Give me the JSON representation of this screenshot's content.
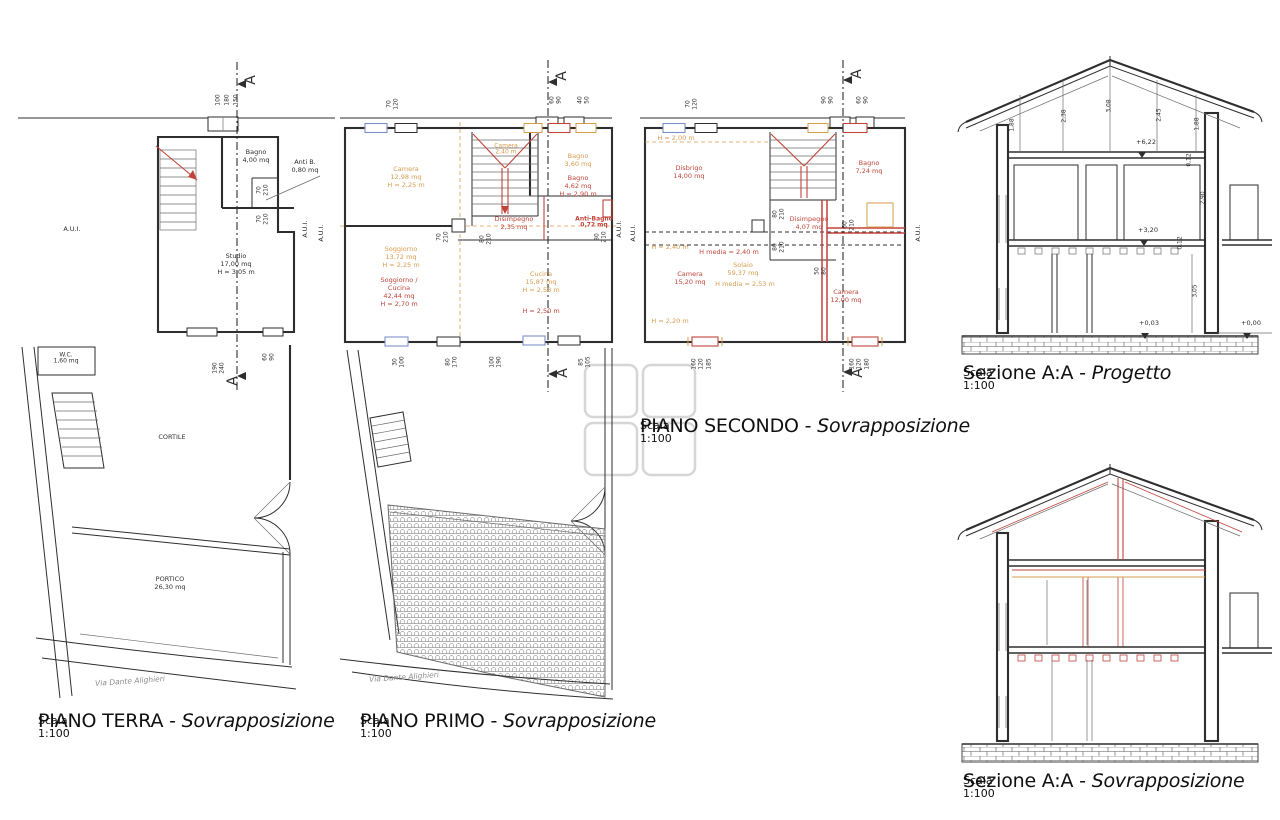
{
  "colors": {
    "ink": "#2e2e2e",
    "mid": "#6e6e6e",
    "red": "#c0443a",
    "orange": "#d79b4e",
    "blue": "#7d8fc9",
    "gray": "#8c8c8c",
    "watermark": "#d6d6d6"
  },
  "titles": {
    "terra": {
      "main": "PIANO TERRA - ",
      "em": "Sovrapposizione",
      "scale": "Scala 1:100"
    },
    "primo": {
      "main": "PIANO PRIMO - ",
      "em": "Sovrapposizione",
      "scale": "Scala 1:100"
    },
    "secondo": {
      "main": "PIANO SECONDO - ",
      "em": "Sovrapposizione",
      "scale": "Scala 1:100"
    },
    "sez_progetto": {
      "main": "Sezione A:A - ",
      "em": "Progetto",
      "scale": "Scala 1:100"
    },
    "sez_sovra": {
      "main": "Sezione A:A - ",
      "em": "Sovrapposizione",
      "scale": "Scala 1:100"
    }
  },
  "terra": {
    "marker": "A",
    "labels": {
      "bagno": "Bagno\n4,00 mq",
      "antib": "Anti B.\n0,80 mq",
      "studio": "Studio\n17,00 mq\nH = 3,05 m",
      "aui": "A.U.I.",
      "aui_r1": "A.U.I.",
      "aui_r2": "A.U.I.",
      "wc": "W.C.\n1,60 mq",
      "cortile": "CORTILE",
      "portico": "PORTICO\n26,30 mq",
      "via": "Via Dante Alighieri"
    },
    "dims": {
      "t1": "100",
      "t2": "180",
      "t3": "150",
      "d1": "70\n210",
      "d2": "70\n210",
      "b1": "190\n240",
      "b2": "60\n90"
    }
  },
  "primo": {
    "marker": "A",
    "aui1": "A.U.I.",
    "aui2": "A.U.I.",
    "old": {
      "camera": "Camera\n12,98 mq\nH = 2,25 m",
      "camera2": "Camera\n2,40 m",
      "bagno": "Bagno\n3,60 mq",
      "soggiorno": "Soggiorno\n13,72 mq\nH = 2,25 m",
      "cucina": "Cucina\n15,87 mq\nH = 2,58 m"
    },
    "new": {
      "bagno": "Bagno\n4,62 mq\nH = 2,90 m",
      "disimpegno": "Disimpegno\n2,35 mq",
      "antibagno": "Anti-Bagno\n0,72 mq",
      "soggiorno": "Soggiorno /\nCucina\n42,44 mq\nH = 2,70 m",
      "cucina_h": "H = 2,50 m"
    },
    "via": "Via Dante Alighieri",
    "dims": {
      "top": "70\n120",
      "w1": "60\n90",
      "w2": "40\n50",
      "c1": "70\n210",
      "c2": "80\n210",
      "r1": "80\n210",
      "b1": "30\n100",
      "b2": "80\n170",
      "b3": "100\n190",
      "b4": "85\n105"
    }
  },
  "secondo": {
    "marker": "A",
    "aui": "A.U.I.",
    "old": {
      "h200": "H = 2,00 m",
      "h240": "H = 2,40 m",
      "solaio": "Solaio\n59,37 mq",
      "hmedia": "H media = 2,53 m",
      "h220": "H = 2,20 m"
    },
    "new": {
      "disbrigo": "Disbrigo\n14,00 mq",
      "bagno": "Bagno\n7,24 mq",
      "disimpegno": "Disimpegno\n4,07 mq",
      "hmedia": "H media = 2,40 m",
      "camera1": "Camera\n15,20 mq",
      "camera2": "Camera\n12,00 mq"
    },
    "dims": {
      "top": "70\n120",
      "w1": "90\n90",
      "w2": "60\n90",
      "c1": "80\n210",
      "c2": "80\n210",
      "c3": "60\n210",
      "c4": "50\n80",
      "b1": "160\n120",
      "b1b": "185",
      "b2": "160\n120",
      "b2b": "180"
    }
  },
  "sezione_progetto": {
    "dims": {
      "a1": "1,88",
      "a2": "2,38",
      "a3": "3,08",
      "a4": "2,45",
      "a5": "1,88",
      "f1": "0,12",
      "h290": "2,90",
      "f2": "0,12",
      "h305": "3,05"
    },
    "levels": {
      "l622": "+6,22",
      "l320": "+3,20",
      "l003": "+0,03",
      "l000": "+0,00"
    }
  }
}
